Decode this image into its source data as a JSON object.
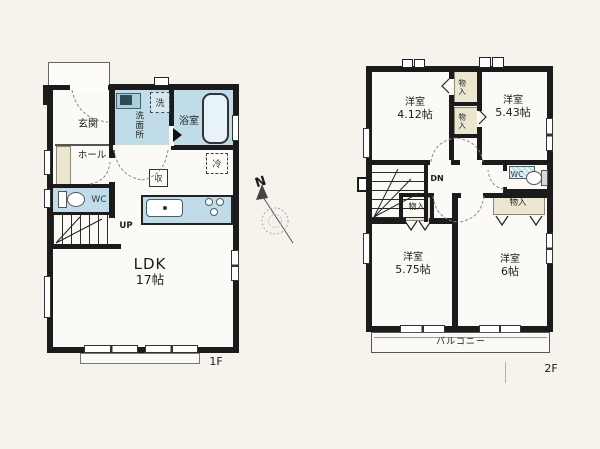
{
  "floor1": {
    "floor_label": "1F",
    "genkan": "玄関",
    "hall": "ホール",
    "wc": "WC",
    "up": "UP",
    "washroom": "洗面所",
    "bath": "浴室",
    "washer_mark": "洗",
    "fridge_mark": "冷",
    "storage_mark": "収",
    "ldk": {
      "name": "LDK",
      "size": "17帖"
    }
  },
  "floor2": {
    "floor_label": "2F",
    "dn": "DN",
    "wc": "WC",
    "closet": "物入",
    "balcony": "バルコニー",
    "rooms": [
      {
        "name": "洋室",
        "size": "4.12帖"
      },
      {
        "name": "洋室",
        "size": "5.43帖"
      },
      {
        "name": "洋室",
        "size": "5.75帖"
      },
      {
        "name": "洋室",
        "size": "6帖"
      }
    ]
  },
  "compass": {
    "north": "N"
  },
  "colors": {
    "wall": "#1b1b1b",
    "wet_area": "#bfdce8",
    "closet_fill": "#eae6cf",
    "paper": "#f5f3ec"
  }
}
